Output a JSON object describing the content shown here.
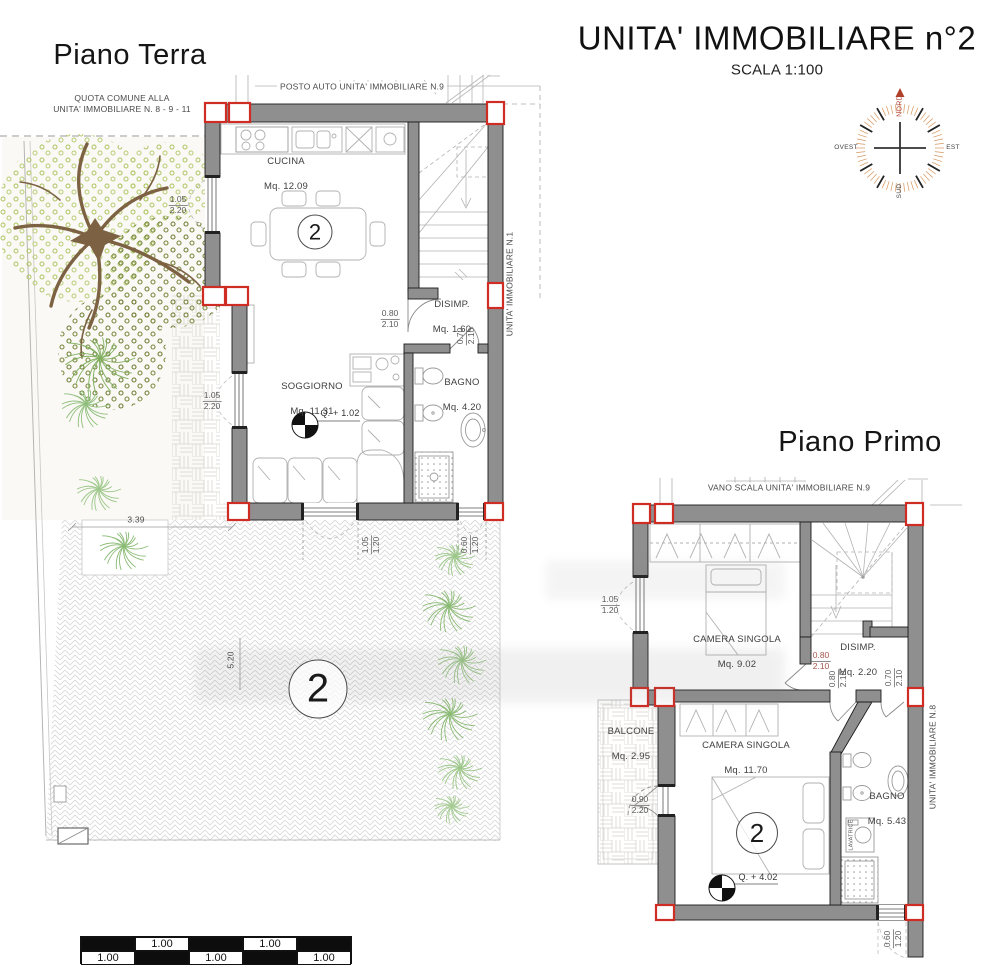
{
  "title": {
    "text": "UNITA' IMMOBILIARE n°2",
    "scale": "SCALA 1:100"
  },
  "floors": {
    "ground": "Piano Terra",
    "first": "Piano Primo"
  },
  "compass": {
    "north": "NORD",
    "south": "SUD",
    "east": "EST",
    "west": "OVEST"
  },
  "notes": {
    "quota_comune": "QUOTA COMUNE ALLA\nUNITA' IMMOBILIARE N. 8 - 9 - 11",
    "posto_auto": "POSTO AUTO UNITA' IMMOBILIARE N.9",
    "vano_scala": "VANO SCALA UNITA' IMMOBILIARE N.9",
    "unit_right_ground": "UNITA' IMMOBILIARE N.1",
    "unit_right_first": "UNITA' IMMOBILIARE N.8",
    "lavatrice": "LAVATRICE"
  },
  "unit_number": "2",
  "ground_rooms": {
    "cucina": {
      "name": "CUCINA",
      "area": "Mq. 12.09"
    },
    "soggiorno": {
      "name": "SOGGIORNO",
      "area": "Mq. 11.31",
      "quota": "Q. + 1.02"
    },
    "disimp": {
      "name": "DISIMP.",
      "area": "Mq. 1.60"
    },
    "bagno": {
      "name": "BAGNO",
      "area": "Mq. 4.20"
    }
  },
  "first_rooms": {
    "camera_singola_1": {
      "name": "CAMERA SINGOLA",
      "area": "Mq. 9.02"
    },
    "disimp": {
      "name": "DISIMP.",
      "area": "Mq. 2.20"
    },
    "camera_singola_2": {
      "name": "CAMERA SINGOLA",
      "area": "Mq. 11.70",
      "quota": "Q. + 4.02"
    },
    "balcone": {
      "name": "BALCONE",
      "area": "Mq. 2.95"
    },
    "bagno": {
      "name": "BAGNO",
      "area": "Mq. 5.43"
    }
  },
  "dims": {
    "ground": {
      "kitchen_window": {
        "w": "1.05",
        "h": "2.20"
      },
      "living_window": {
        "w": "1.05",
        "h": "2.20"
      },
      "disimp_door": {
        "w": "0.80",
        "h": "2.10"
      },
      "bagno_door": {
        "w": "0.70",
        "h": "2.10"
      },
      "south_window": {
        "w": "1.05",
        "h": "1.20"
      },
      "south_window_small": {
        "w": "0.60",
        "h": "1.20"
      },
      "garden_width": "3.39",
      "parking_length": "5.20"
    },
    "first": {
      "west_window": {
        "w": "1.05",
        "h": "1.20"
      },
      "camera_door": {
        "w": "0.80",
        "h": "2.10"
      },
      "disimp_door": {
        "w": "0.80",
        "h": "2.10"
      },
      "bagno_door": {
        "w": "0.70",
        "h": "2.10"
      },
      "balcone_door": {
        "w": "0.90",
        "h": "2.20"
      },
      "south_window": {
        "w": "0.60",
        "h": "1.20"
      }
    }
  },
  "scalebar": {
    "labels": [
      "1.00",
      "1.00",
      "1.00",
      "1.00",
      "1.00"
    ]
  },
  "colors": {
    "wall": "#8f8f8f",
    "marker": "#cf2c24",
    "north_arrow": "#b0402a",
    "foliage_light": "#b5ca6e",
    "foliage_dark": "#6f7e35",
    "fern": "#8fbf7c",
    "trunk": "#7c6243"
  }
}
